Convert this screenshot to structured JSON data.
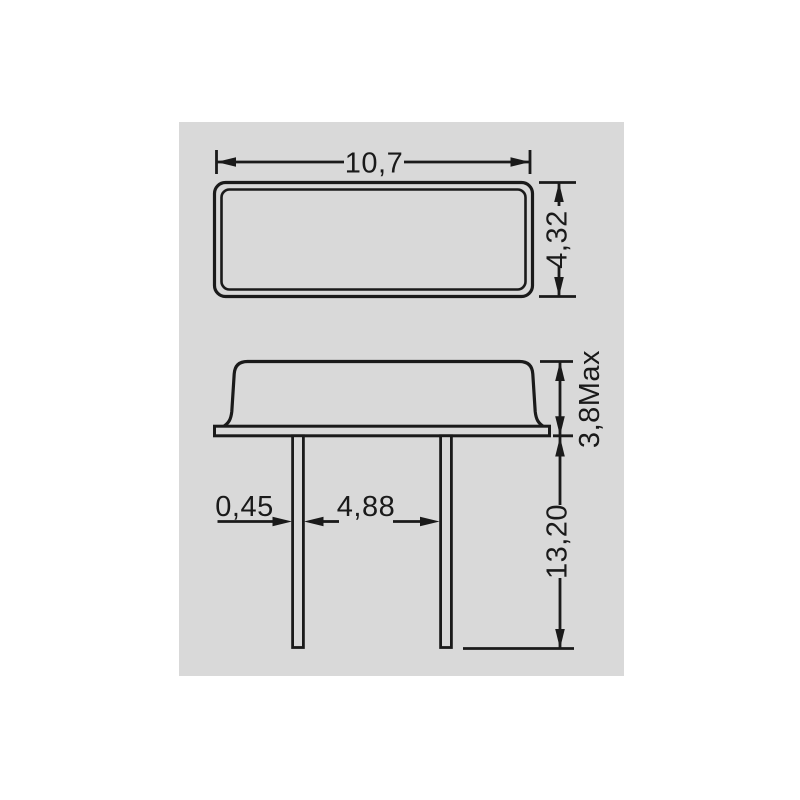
{
  "colors": {
    "page_bg": "#ffffff",
    "panel_bg": "#d9d9d9",
    "line": "#1a1a1a"
  },
  "drawing": {
    "kind": "mechanical-dimension-drawing",
    "units": "mm",
    "top_view": {
      "width": {
        "label": "10,7",
        "value": 10.7
      },
      "height": {
        "label": "4,32",
        "value": 4.32
      }
    },
    "side_view": {
      "body_height": {
        "label": "3,8Max",
        "value": 3.8
      },
      "lead_width": {
        "label": "0,45",
        "value": 0.45
      },
      "lead_spacing": {
        "label": "4,88",
        "value": 4.88
      },
      "lead_length": {
        "label": "13,20",
        "value": 13.2
      }
    }
  }
}
